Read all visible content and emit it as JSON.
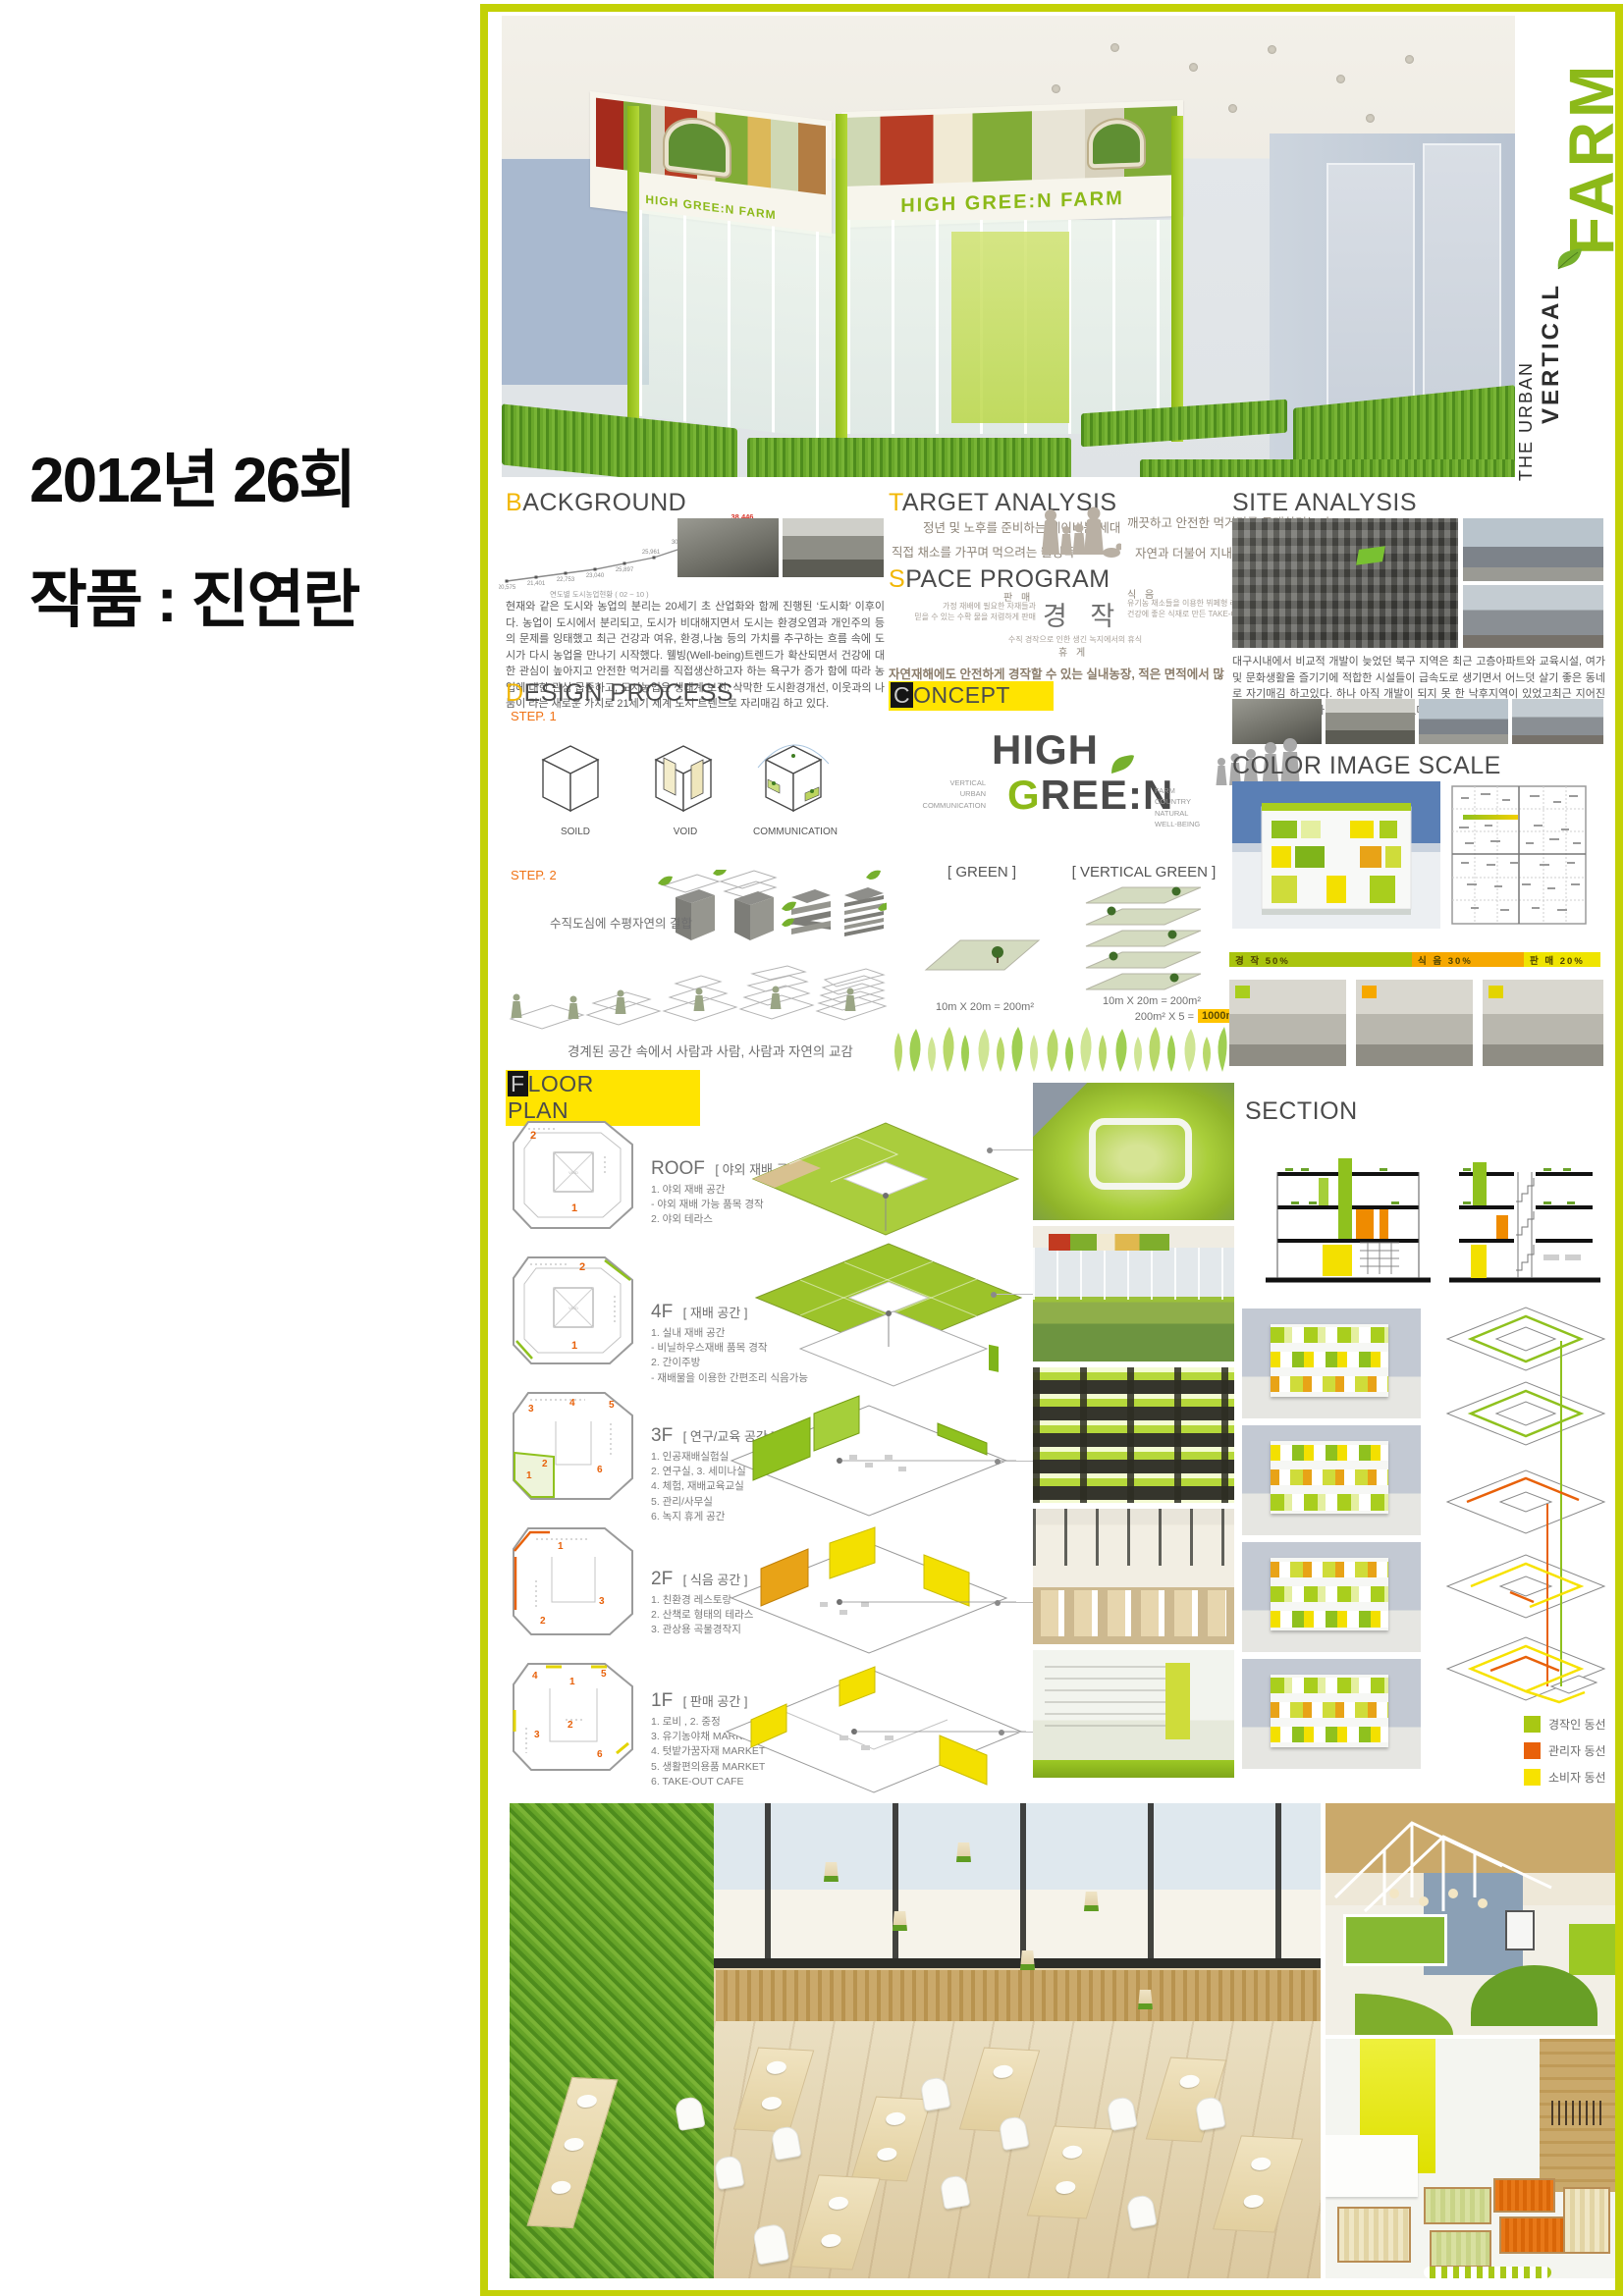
{
  "left_panel": {
    "line1": "2012년 26회",
    "line2": "작품 : 진연란"
  },
  "hero": {
    "banner_left": "HIGH GREE:N FARM",
    "banner_right": "HIGH GREE:N FARM",
    "side_top": "THE URBAN",
    "side_mid": "VERTICAL",
    "side_main": "FARM",
    "accent_green": "#8cb919"
  },
  "background": {
    "heading": "BACKGROUND",
    "chart_caption": "연도별 도시농업현황 ( 02 ~ 10 )",
    "chart_data": {
      "type": "line",
      "labels": [
        "20,575",
        "21,401",
        "22,753",
        "23,040",
        "25,897",
        "25,961",
        "30,292",
        "34,379",
        "38,446"
      ],
      "values": [
        20575,
        21401,
        22753,
        23040,
        25897,
        25961,
        30292,
        34379,
        38446
      ],
      "highlight_last_color": "#d8352a"
    },
    "paragraph": "현재와 같은 도시와 농업의 분리는 20세기 초 산업화와 함께 진행된 ‘도시화’ 이후이다. 농업이 도시에서 분리되고, 도시가 비대해지면서 도시는 환경오염과 개인주의 등의 문제를 잉태했고 최근 건강과 여유, 환경,나눔 등의 가치를 추구하는 흐름 속에 도시가 다시 농업을 만나기 시작했다. 웰빙(Well-being)트렌드가 확산되면서 건강에 대한 관심이 높아지고 안전한 먹거리를 직접생산하고자 하는 욕구가 증가 함에 따라 농업에 대한 관심 급증하고, 도시농업은 생태계 보전, 삭막한 도시환경개선, 이웃과의 나눔이 라는 새로운 가치로 21세기 세계 도시 트렌드로 자리매김 하고 있다."
  },
  "target": {
    "heading": "TARGET ANALYSIS",
    "items": [
      "정년 및 노후를 준비하는 베이비붐 세대",
      "직접 채소를 가꾸며 먹으려는 웰빙족",
      "깨끗하고 안전한 먹거리를 구매하려는 人",
      "자연과 더불어 지내고 싶은 도심거주민"
    ]
  },
  "space": {
    "heading": "SPACE PROGRAM",
    "sell_label": "판 매",
    "sell_desc": "가정 재배에 필요한 자재들과\n믿을 수 있는 수확 물을 저렴하게 판매",
    "center": "경 작",
    "eat_label": "식 음",
    "eat_desc": "유기농 채소들을 이용한 뷔페형 레스토랑 운영\n건강에 좋은 식재로 만든 TAKE-OUT 카페운영",
    "rest_desc": "수직 경작으로 인한 생긴 녹지에서의 휴식",
    "rest_label": "휴 게",
    "note": "자연재해에도 안전하게 경작할 수 있는 실내농장, 적은 면적에서 많은 수확을 위한 효율적 경작"
  },
  "site": {
    "heading": "SITE ANALYSIS",
    "paragraph": "대구시내에서 비교적 개발이 늦었던 북구 지역은 최근 고층아파트와 교육시설, 여가 및 문화생활을 즐기기에 적합한 시설들이 급속도로 생기면서 어느덧 살기 좋은 동네로 자기매김 하고있다. 하나 아직 개발이 되지 못 한 낙후지역이 있었고최근 지어진 현대식 주위시설들과 많은 차이가 나고 있다."
  },
  "design": {
    "heading": "DESIGN PROCESS",
    "step1": "STEP. 1",
    "items": [
      "SOILD",
      "VOID",
      "COMMUNICATION"
    ],
    "step2": "STEP. 2",
    "cap1": "수직도심에 수평자연의 결합",
    "cap2": "경계된 공간 속에서 사람과 사람, 사람과 자연의 교감"
  },
  "concept": {
    "heading": "CONCEPT",
    "left_words": "VERTICAL\nURBAN\nCOMMUNICATION",
    "logo1": "HIGH",
    "logo2": "GREE:N",
    "right_words": "FARM\nCOUNTRY\nNATURAL\nWELL-BEING",
    "green_label": "[ GREEN ]",
    "green_formula": "10m X 20m = 200m²",
    "vgreen_label": "[ VERTICAL GREEN ]",
    "vgreen_f1": "10m X 20m = 200m²",
    "vgreen_f2": "200m² X 5 =",
    "vgreen_hl": "1000m²",
    "highlight_color": "#ffc400"
  },
  "cis": {
    "heading": "COLOR IMAGE SCALE",
    "bar": [
      {
        "label": "경 작 50%",
        "color": "#a9c40e",
        "ratio": 50
      },
      {
        "label": "식 음 30%",
        "color": "#f6a800",
        "ratio": 30
      },
      {
        "label": "판 매 20%",
        "color": "#efe400",
        "ratio": 20
      }
    ]
  },
  "fp": {
    "heading": "FLOOR PLAN",
    "floors": [
      {
        "name": "ROOF",
        "title": "[ 야외 재배 공간 ]",
        "void": "VOID",
        "accent": "#b5b5b5",
        "details": "1. 야외 재배 공간\n- 야외 재배 가능 품목 경작\n2. 야외 테라스",
        "nums": [
          "1",
          "2"
        ]
      },
      {
        "name": "4F",
        "title": "[ 재배 공간 ]",
        "void": "VOID",
        "accent": "#8fc11e",
        "details": "1. 실내 재배 공간\n- 비닐하우스재배 품목 경작\n2. 간이주방\n- 재배물을 이용한 간편조리 식음가능",
        "nums": [
          "1",
          "2"
        ]
      },
      {
        "name": "3F",
        "title": "[ 연구/교육 공간 ]",
        "void": "",
        "accent": "#8fc11e",
        "details": "1. 인공재배실험실\n2. 연구실,  3. 세미나실\n4. 체험, 재배교육교실\n5. 관리/사무실\n6. 녹지 휴게 공간",
        "nums": [
          "1",
          "2",
          "3",
          "4",
          "5",
          "6"
        ]
      },
      {
        "name": "2F",
        "title": "[ 식음 공간 ]",
        "void": "",
        "accent": "#e8610a",
        "details": "1. 친환경 레스토랑\n2. 산책로 형태의 테라스\n3. 관상용 곡물경작지",
        "nums": [
          "1",
          "2",
          "3"
        ]
      },
      {
        "name": "1F",
        "title": "[ 판매 공간 ]",
        "void": "",
        "accent": "#e3d400",
        "details": "1. 로비 , 2. 중정\n3. 유기농야채 MARKET\n4. 텃밭가꿈자재 MARKET\n5. 생활편의용품 MARKET\n6. TAKE-OUT CAFE",
        "nums": [
          "1",
          "2",
          "3",
          "4",
          "5",
          "6"
        ]
      }
    ]
  },
  "section": {
    "heading": "SECTION"
  },
  "legend": {
    "items": [
      {
        "label": "경작인 동선",
        "color": "#a8c813"
      },
      {
        "label": "관리자 동선",
        "color": "#e8610a"
      },
      {
        "label": "소비자 동선",
        "color": "#f7e200"
      }
    ]
  }
}
